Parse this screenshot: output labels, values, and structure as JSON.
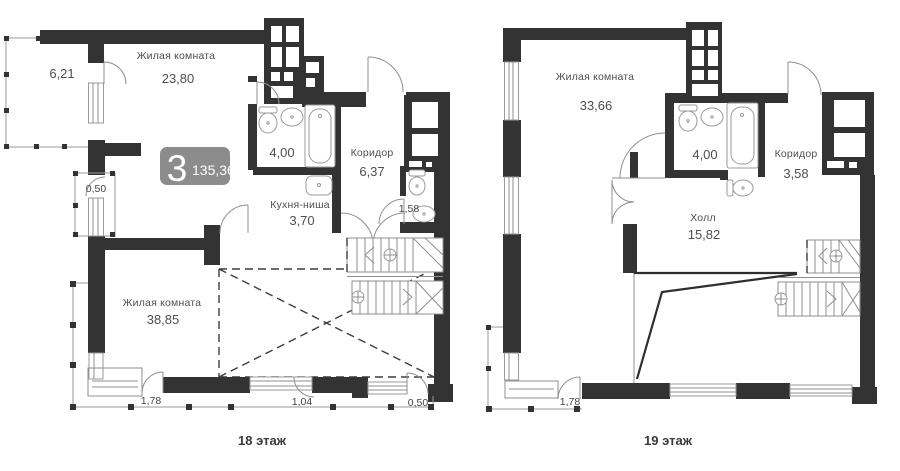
{
  "colors": {
    "wall": "#333333",
    "thin_line": "#8f8f8f",
    "text": "#4e4e4e",
    "badge_bg": "#8c8c8c",
    "badge_text": "#ffffff",
    "background": "#ffffff"
  },
  "badge": {
    "rooms": "3",
    "total_area": "135,36"
  },
  "plan18": {
    "caption": "18 этаж",
    "rooms": {
      "living_top": {
        "name": "Жилая комната",
        "area": "23,80"
      },
      "living_bottom": {
        "name": "Жилая комната",
        "area": "38,85"
      },
      "kitchen": {
        "name": "Кухня-ниша",
        "area": "3,70"
      },
      "corridor": {
        "name": "Коридор",
        "area": "6,37"
      },
      "bathroom": {
        "area": "4,00"
      },
      "wc": {
        "area": "1,58"
      },
      "balcony_top": {
        "area": "6,21"
      },
      "balcony_left": {
        "area": "0,50"
      },
      "balcony_b1": {
        "area": "1,78"
      },
      "balcony_b2": {
        "area": "1,04"
      },
      "balcony_b3": {
        "area": "0,50"
      }
    }
  },
  "plan19": {
    "caption": "19 этаж",
    "rooms": {
      "living": {
        "name": "Жилая комната",
        "area": "33,66"
      },
      "hall": {
        "name": "Холл",
        "area": "15,82"
      },
      "corridor": {
        "name": "Коридор",
        "area": "3,58"
      },
      "bathroom": {
        "area": "4,00"
      },
      "balcony": {
        "area": "1,78"
      }
    }
  }
}
